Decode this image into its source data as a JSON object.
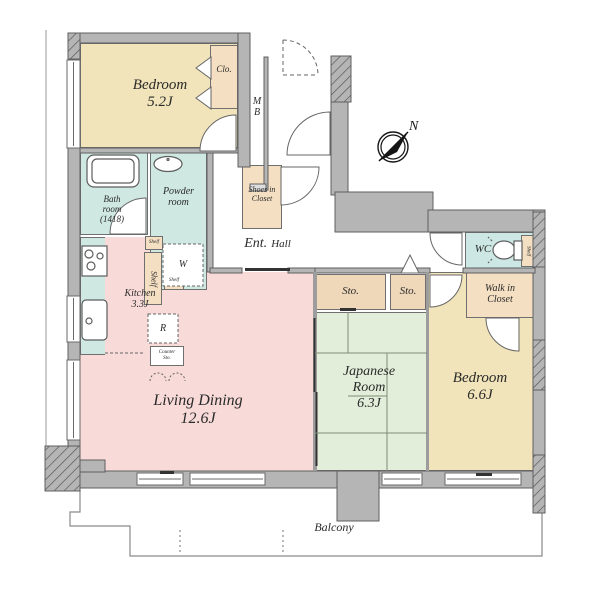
{
  "floor_plan": {
    "colors": {
      "wall": "#b5b5b5",
      "wall_outline": "#5f5f5f",
      "bedroom_fill": "#f1e4ba",
      "closet_fill": "#f4dfc2",
      "storage_fill": "#efd8ba",
      "wet_area_fill": "#cfe8e2",
      "living_fill": "#f8dbd8",
      "japanese_fill": "#e2eed9",
      "text": "#2a2a2a"
    },
    "rooms": {
      "bedroom1": {
        "name": "Bedroom",
        "size": "5.2J"
      },
      "closet1": {
        "label": "Clo."
      },
      "meter_box": {
        "line1": "M",
        "line2": "B"
      },
      "bathroom": {
        "line1": "Bath",
        "line2": "room",
        "line3": "(1418)"
      },
      "powder_room": {
        "line1": "Powder",
        "line2": "room"
      },
      "kitchen": {
        "name": "Kitchen",
        "size": "3.3J"
      },
      "shelf_tall": {
        "label": "Shelf"
      },
      "shelf_small_1": {
        "label": "Shelf"
      },
      "shelf_small_2": {
        "label": "Shelf"
      },
      "washer_space": {
        "label": "W"
      },
      "refrigerator_space": {
        "label": "R"
      },
      "counter_storage": {
        "line1": "Counter",
        "line2": "Sto."
      },
      "shoes_in_closet": {
        "line1": "Shoes in",
        "line2": "Closet"
      },
      "entrance_hall": {
        "ent": "Ent.",
        "hall": "Hall"
      },
      "wc": {
        "label": "WC"
      },
      "wc_shelf": {
        "label": "Shelf"
      },
      "walk_in_closet": {
        "line1": "Walk in",
        "line2": "Closet"
      },
      "storage1": {
        "label": "Sto."
      },
      "storage2": {
        "label": "Sto."
      },
      "japanese_room": {
        "line1": "Japanese",
        "line2": "Room",
        "size": "6.3J"
      },
      "bedroom2": {
        "name": "Bedroom",
        "size": "6.6J"
      },
      "living_dining": {
        "name": "Living Dining",
        "size": "12.6J"
      },
      "balcony": {
        "label": "Balcony"
      }
    },
    "compass": {
      "label": "N"
    }
  }
}
